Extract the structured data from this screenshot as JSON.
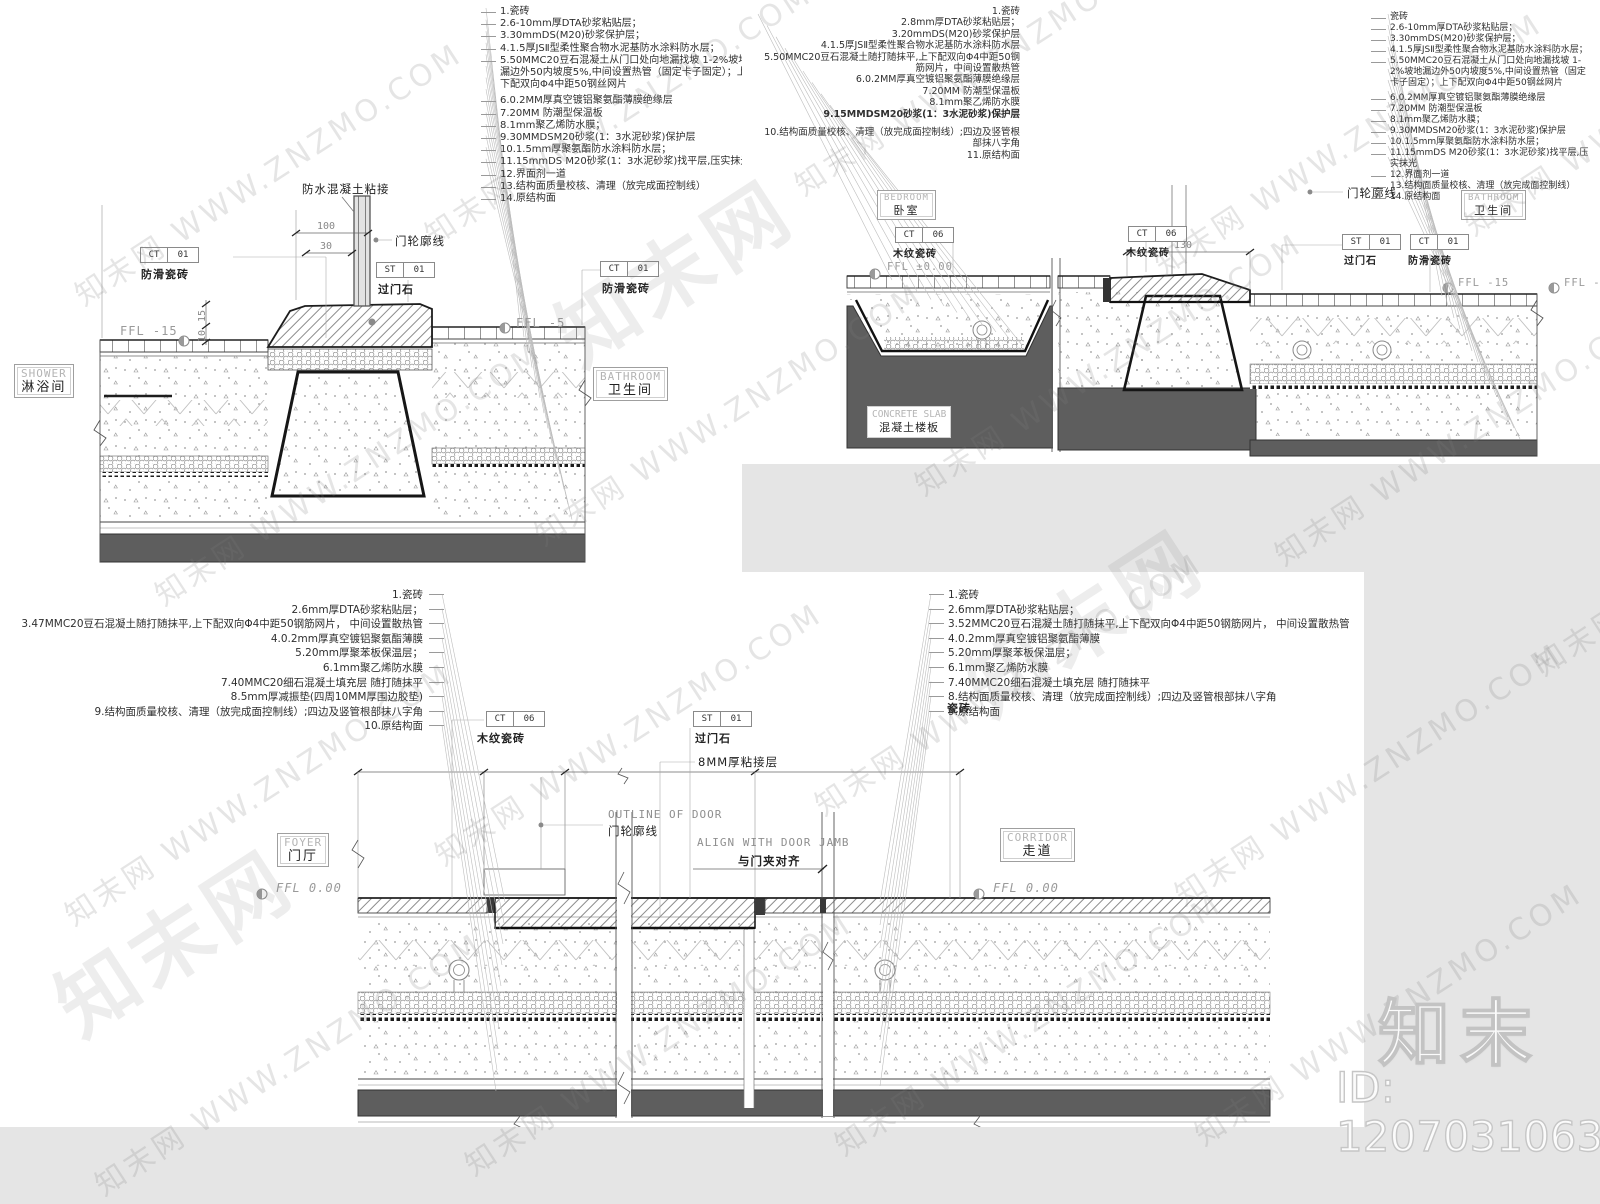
{
  "page": {
    "background": "#e5e5e5",
    "sheet": "#ffffff",
    "line_color": "#444444",
    "slab_color": "#5e5e5e"
  },
  "watermark": {
    "tile": "知末网 WWW.ZNZMO.COM",
    "logo": "知末",
    "id": "ID: 1207031063"
  },
  "d1": {
    "notes": [
      "1.瓷砖",
      "2.6-10mm厚DTA砂浆粘贴层；",
      "3.30mmDS(M20)砂浆保护层；",
      "4.1.5厚JSⅡ型柔性聚合物水泥基防水涂料防水层；",
      "5.50MMC20豆石混凝土从门口处向地漏找坡 1-2%坡地漏边外50内坡度5%,中间设置热管（固定卡子固定）；上下配双向Φ4中距50钢丝网片",
      "6.0.2MM厚真空镀铝聚氨酯薄膜绝缘层",
      "7.20MM 防潮型保温板",
      "8.1mm聚乙烯防水膜；",
      "9.30MMDSM20砂浆(1：3水泥砂浆)保护层",
      "10.1.5mm厚聚氨酯防水涂料防水层；",
      "11.15mmDS M20砂浆(1：3水泥砂浆)找平层,压实抹光",
      "12.界面剂一道",
      "13.结构面质量校核、清理（放完成面控制线）",
      "14.原结构面"
    ],
    "room_left_en": "SHOWER",
    "room_left_zh": "淋浴间",
    "room_right_en": "BATHROOM",
    "room_right_zh": "卫生间",
    "tag_ct": {
      "code": "CT",
      "num": "01",
      "label": "防滑瓷砖"
    },
    "tag_st": {
      "code": "ST",
      "num": "01",
      "label": "过门石"
    },
    "ffl_left": "FFL -15",
    "ffl_right": "FFL -5",
    "callout_concrete": "防水混凝土粘接",
    "callout_door": "门轮廓线",
    "dim_100": "100",
    "dim_30": "30",
    "dim_15": "15",
    "dim_10": "10"
  },
  "d2": {
    "notes": [
      "1.瓷砖",
      "2.8mm厚DTA砂浆粘贴层；",
      "3.20mmDS(M20)砂浆保护层",
      "4.1.5厚JSⅡ型柔性聚合物水泥基防水涂料防水层",
      "5.50MMC20豆石混凝土随打随抹平,上下配双向Φ4中距50钢筋网片，中间设置散热管",
      "6.0.2MM厚真空镀铝聚氨酯薄膜绝缘层",
      "7.20MM 防潮型保温板",
      "8.1mm聚乙烯防水膜",
      "9.15MMDSM20砂浆(1：3水泥砂浆)保护层",
      "10.结构面质量校核、清理（放完成面控制线）;四边及竖管根部抹八字角",
      "11.原结构面"
    ],
    "notes_right": [
      "瓷砖",
      "2.6-10mm厚DTA砂浆粘贴层；",
      "3.30mmDS(M20)砂浆保护层；",
      "4.1.5厚JSⅡ型柔性聚合物水泥基防水涂料防水层；",
      "5.50MMC20豆石混凝土从门口处向地漏找坡 1-2%坡地漏边外50内坡度5%,中间设置热管（固定卡子固定）；上下配双向Φ4中距50钢丝网片",
      "6.0.2MM厚真空镀铝聚氨酯薄膜绝缘层",
      "7.20MM 防潮型保温板",
      "8.1mm聚乙烯防水膜；",
      "9.30MMDSM20砂浆(1：3水泥砂浆)保护层",
      "10.1.5mm厚聚氨酯防水涂料防水层；",
      "11.15mmDS M20砂浆(1：3水泥砂浆)找平层,压实抹光",
      "12.界面剂一道",
      "13.结构面质量校核、清理（放完成面控制线）",
      "14.原结构面"
    ],
    "room_left_en": "BEDROOM",
    "room_left_zh": "卧室",
    "room_right_en": "BATHROOM",
    "room_right_zh": "卫生间",
    "slab_en": "CONCRETE SLAB",
    "slab_zh": "混凝土楼板",
    "tag_ct06": {
      "code": "CT",
      "num": "06",
      "label": "木纹瓷砖"
    },
    "tag_ct01": {
      "code": "CT",
      "num": "01",
      "label": "防滑瓷砖"
    },
    "tag_st": {
      "code": "ST",
      "num": "01",
      "label": "过门石"
    },
    "ffl_left": "FFL ±0.00",
    "ffl_right": "FFL -15",
    "callout_door": "门轮廓线",
    "dim_130": "130"
  },
  "d3": {
    "notes_left": [
      "1.瓷砖",
      "2.6mm厚DTA砂浆粘贴层；",
      "3.47MMC20豆石混凝土随打随抹平,上下配双向Φ4中距50钢筋网片， 中间设置散热管",
      "4.0.2mm厚真空镀铝聚氨酯薄膜",
      "5.20mm厚聚苯板保温层；",
      "6.1mm聚乙烯防水膜",
      "7.40MMC20细石混凝土填充层 随打随抹平",
      "8.5mm厚减振垫(四周10MM厚围边胶垫)",
      "9.结构面质量校核、清理（放完成面控制线）;四边及竖管根部抹八字角",
      "10.原结构面"
    ],
    "notes_right": [
      "1.瓷砖",
      "2.6mm厚DTA砂浆粘贴层；",
      "3.52MMC20豆石混凝土随打随抹平,上下配双向Φ4中距50钢筋网片， 中间设置散热管",
      "4.0.2mm厚真空镀铝聚氨酯薄膜",
      "5.20mm厚聚苯板保温层；",
      "6.1mm聚乙烯防水膜",
      "7.40MMC20细石混凝土填充层 随打随抹平",
      "8.结构面质量校核、清理（放完成面控制线）;四边及竖管根部抹八字角",
      "9.原结构面"
    ],
    "room_left_en": "FOYER",
    "room_left_zh": "门厅",
    "room_right_en": "CORRIDOR",
    "room_right_zh": "走道",
    "tag_ct06": {
      "code": "CT",
      "num": "06",
      "label": "木纹瓷砖"
    },
    "tag_st": {
      "code": "ST",
      "num": "01",
      "label": "过门石"
    },
    "label_tile": "瓷砖",
    "label_bond": "8MM厚粘接层",
    "door_en": "OUTLINE OF DOOR",
    "door_zh": "门轮廓线",
    "align_en": "ALIGN WITH DOOR JAMB",
    "align_zh": "与门夹对齐",
    "ffl_left": "FFL 0.00",
    "ffl_right": "FFL 0.00"
  }
}
